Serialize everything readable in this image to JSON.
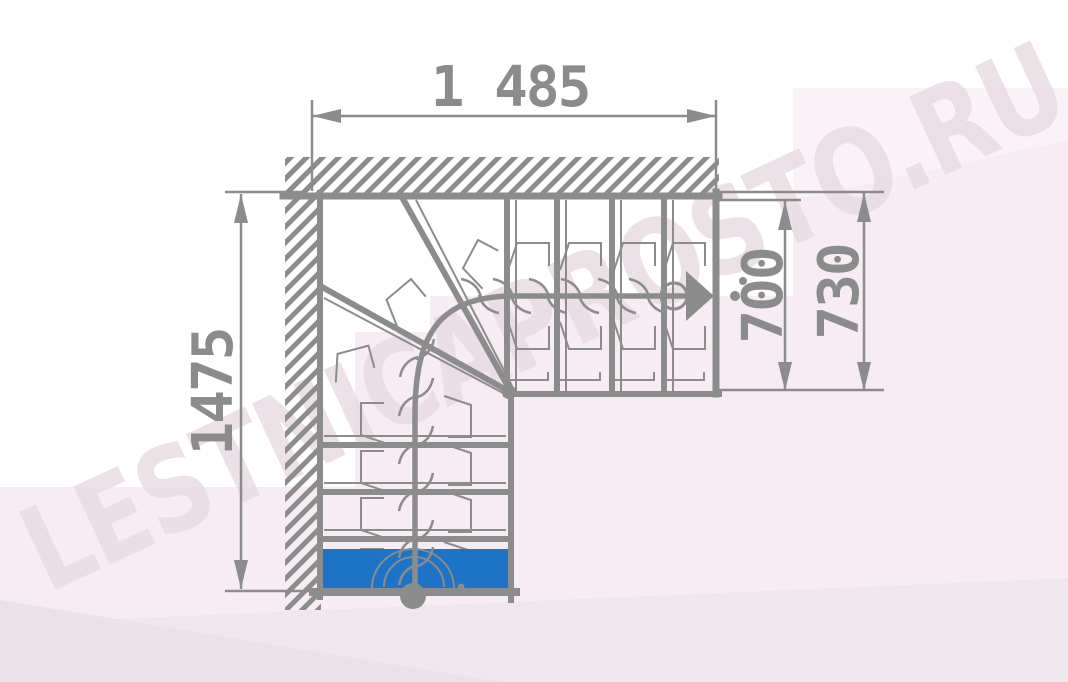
{
  "drawing": {
    "title": "L-shaped staircase plan with winder steps",
    "view": "top-down plan"
  },
  "dimensions": {
    "top": {
      "label": "1 485"
    },
    "left": {
      "label": "1475"
    },
    "right_inner": {
      "label": "700"
    },
    "right_outer": {
      "label": "730"
    }
  },
  "watermark": {
    "text": "LESTNICAPROSTO.RU"
  },
  "stairs": {
    "first_step_highlighted": true,
    "upper_flight_straight_risers": 4,
    "lower_flight_straight_risers": 4,
    "winder_risers": 2,
    "walk_line": "circle start at bottom step, arrow end at upper landing"
  },
  "colors": {
    "line_gray": "#8c8c8c",
    "text_gray": "#8b8b8b",
    "first_step_blue": "#1d73c5",
    "watermark_pink": "#e8dae2",
    "background_pink": "#f7ecf3",
    "background_strip": "#efe7ed",
    "background_corner": "#eae2e9"
  }
}
